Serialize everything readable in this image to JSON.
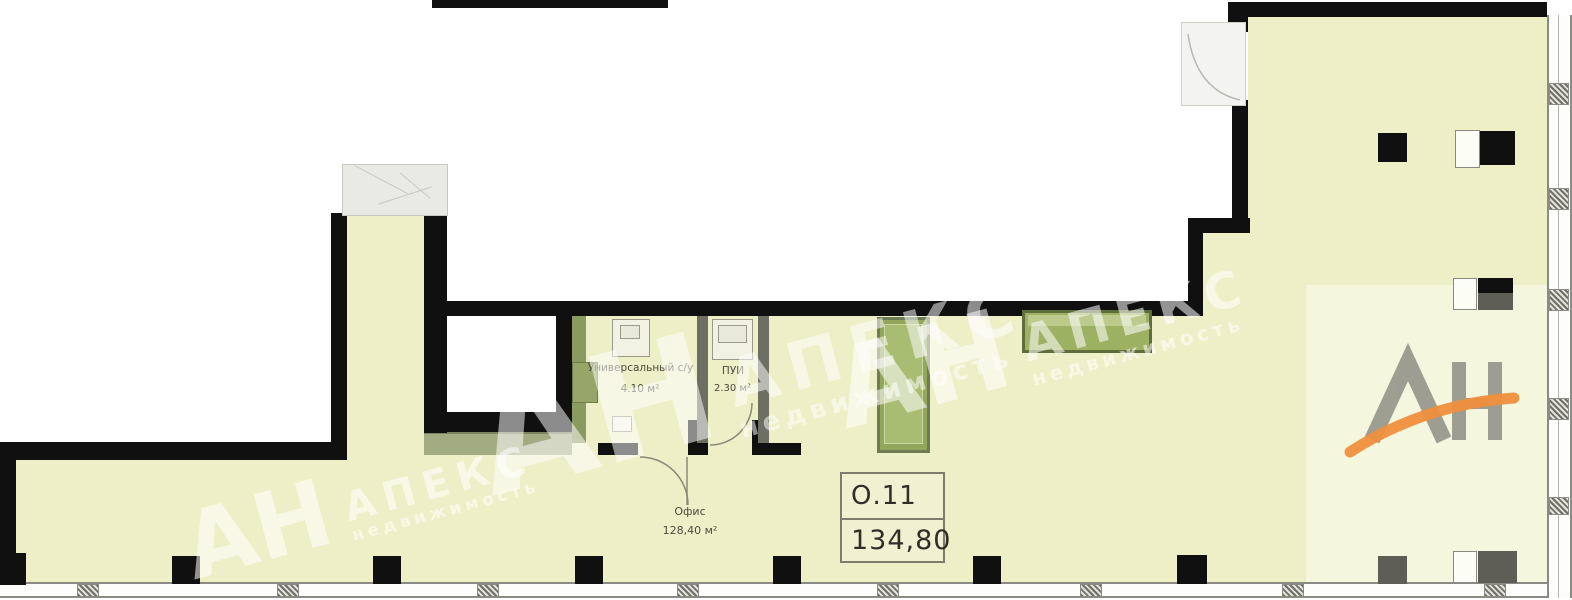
{
  "plan": {
    "unit_box": {
      "number": "О.11",
      "total_area": "134,80"
    },
    "rooms": [
      {
        "name": "Универсальный с/у",
        "area": "4.10 м²"
      },
      {
        "name": "ПУИ",
        "area": "2.30 м²"
      },
      {
        "name": "Офис",
        "area": "128,40 м²"
      }
    ],
    "watermark": {
      "initials": "АН",
      "brand": "АПЕКС",
      "tagline": "недвижимость"
    },
    "logo": {
      "text": "АН"
    },
    "colors": {
      "floor_fill": "#edefc6",
      "wall": "#101010",
      "green_fixture": "#93a75c",
      "logo_gray": "#8e8e84",
      "logo_orange": "#ee8f3c"
    }
  }
}
